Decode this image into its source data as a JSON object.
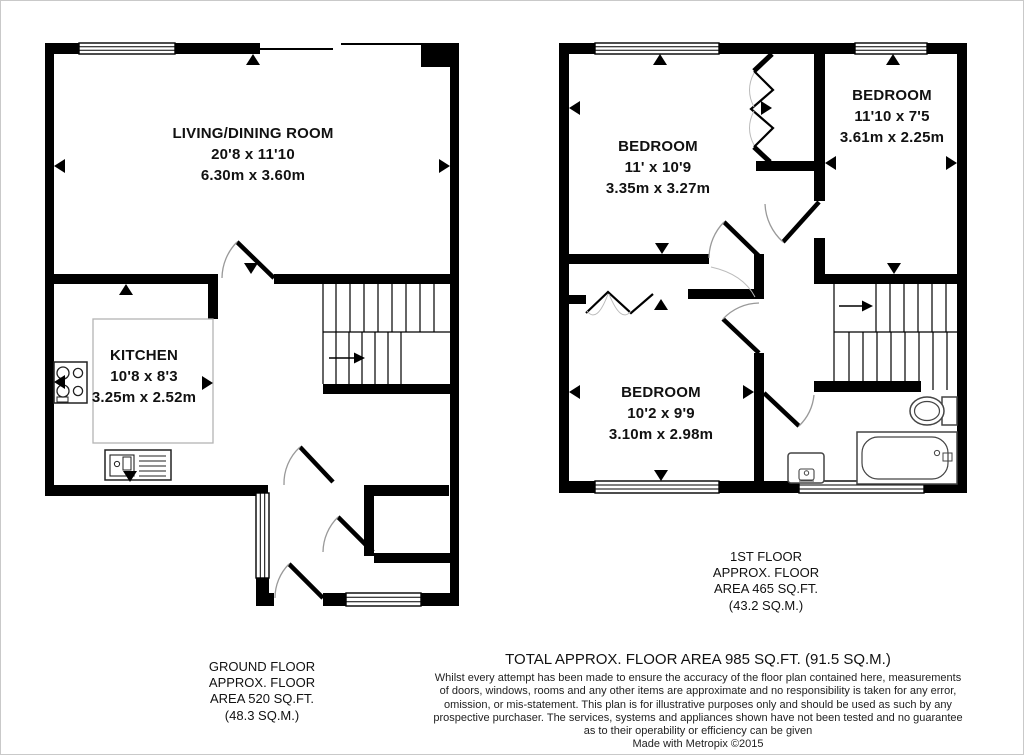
{
  "plan": {
    "ground_floor": {
      "rooms": {
        "living_dining": {
          "name": "LIVING/DINING ROOM",
          "imperial": "20'8 x 11'10",
          "metric": "6.30m x 3.60m"
        },
        "kitchen": {
          "name": "KITCHEN",
          "imperial": "10'8 x 8'3",
          "metric": "3.25m x 2.52m"
        }
      },
      "area_label": [
        "GROUND FLOOR",
        "APPROX. FLOOR",
        "AREA 520 SQ.FT.",
        "(48.3 SQ.M.)"
      ]
    },
    "first_floor": {
      "rooms": {
        "bedroom_1": {
          "name": "BEDROOM",
          "imperial": "11' x 10'9",
          "metric": "3.35m x 3.27m"
        },
        "bedroom_2": {
          "name": "BEDROOM",
          "imperial": "11'10 x 7'5",
          "metric": "3.61m x 2.25m"
        },
        "bedroom_3": {
          "name": "BEDROOM",
          "imperial": "10'2 x 9'9",
          "metric": "3.10m x 2.98m"
        }
      },
      "area_label": [
        "1ST FLOOR",
        "APPROX. FLOOR",
        "AREA 465 SQ.FT.",
        "(43.2 SQ.M.)"
      ]
    },
    "footer": {
      "total": "TOTAL APPROX. FLOOR AREA 985 SQ.FT. (91.5 SQ.M.)",
      "disclaimer": [
        "Whilst every attempt has been made to ensure the accuracy of the floor plan contained here, measurements",
        "of doors, windows, rooms and any other items are approximate and no responsibility is taken for any error,",
        "omission, or mis-statement. This plan is for illustrative purposes only and should be used as such by any",
        "prospective purchaser. The services, systems and appliances shown have not been tested and no guarantee",
        "as to their operability or efficiency can be given"
      ],
      "credit": "Made with Metropix ©2015"
    },
    "colors": {
      "wall": "#000000",
      "counter_outline": "#b4b4b4",
      "arc": "#999999"
    }
  }
}
